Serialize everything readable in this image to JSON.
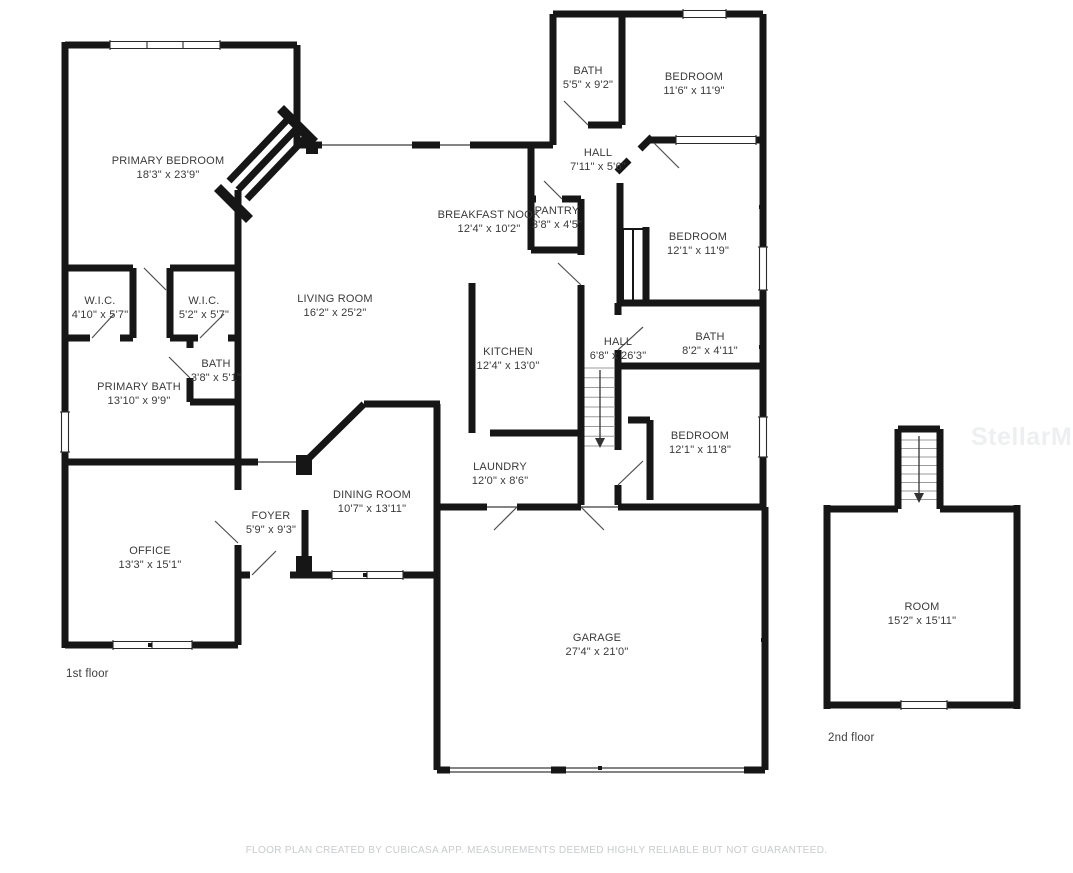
{
  "floorplan": {
    "watermark": "StellarMLS",
    "footer": "FLOOR PLAN CREATED BY CUBICASA APP. MEASUREMENTS DEEMED HIGHLY RELIABLE BUT NOT GUARANTEED.",
    "colors": {
      "wall": "#161616",
      "label": "#3a3a3a",
      "footer": "#c8cbcd",
      "watermark": "#edeff0"
    },
    "floors": [
      {
        "label": "1st floor",
        "label_x": 66,
        "label_y": 668,
        "rooms": [
          {
            "name": "PRIMARY BEDROOM",
            "dims": "18'3\" x 23'9\"",
            "x": 168,
            "y": 155
          },
          {
            "name": "W.I.C.",
            "dims": "4'10\" x 5'7\"",
            "x": 100,
            "y": 295
          },
          {
            "name": "W.I.C.",
            "dims": "5'2\" x 5'7\"",
            "x": 204,
            "y": 295
          },
          {
            "name": "BATH",
            "dims": "3'8\" x 5'1\"",
            "x": 216,
            "y": 358
          },
          {
            "name": "PRIMARY BATH",
            "dims": "13'10\" x 9'9\"",
            "x": 139,
            "y": 381
          },
          {
            "name": "OFFICE",
            "dims": "13'3\" x 15'1\"",
            "x": 150,
            "y": 545
          },
          {
            "name": "FOYER",
            "dims": "5'9\" x 9'3\"",
            "x": 271,
            "y": 510
          },
          {
            "name": "DINING ROOM",
            "dims": "10'7\" x 13'11\"",
            "x": 372,
            "y": 489
          },
          {
            "name": "LIVING ROOM",
            "dims": "16'2\" x 25'2\"",
            "x": 335,
            "y": 293
          },
          {
            "name": "BREAKFAST NOOK",
            "dims": "12'4\" x 10'2\"",
            "x": 489,
            "y": 209
          },
          {
            "name": "PANTRY",
            "dims": "3'8\" x 4'5\"",
            "x": 557,
            "y": 205
          },
          {
            "name": "KITCHEN",
            "dims": "12'4\" x 13'0\"",
            "x": 508,
            "y": 346
          },
          {
            "name": "LAUNDRY",
            "dims": "12'0\" x 8'6\"",
            "x": 500,
            "y": 461
          },
          {
            "name": "HALL",
            "dims": "7'11\" x 5'6\"",
            "x": 598,
            "y": 147
          },
          {
            "name": "HALL",
            "dims": "6'8\" x 26'3\"",
            "x": 618,
            "y": 336
          },
          {
            "name": "BATH",
            "dims": "5'5\" x 9'2\"",
            "x": 588,
            "y": 65
          },
          {
            "name": "BEDROOM",
            "dims": "11'6\" x 11'9\"",
            "x": 694,
            "y": 71
          },
          {
            "name": "BEDROOM",
            "dims": "12'1\" x 11'9\"",
            "x": 698,
            "y": 231
          },
          {
            "name": "BATH",
            "dims": "8'2\" x 4'11\"",
            "x": 710,
            "y": 331
          },
          {
            "name": "BEDROOM",
            "dims": "12'1\" x 11'8\"",
            "x": 700,
            "y": 430
          },
          {
            "name": "GARAGE",
            "dims": "27'4\" x 21'0\"",
            "x": 597,
            "y": 632
          }
        ]
      },
      {
        "label": "2nd floor",
        "label_x": 828,
        "label_y": 732,
        "rooms": [
          {
            "name": "ROOM",
            "dims": "15'2\" x 15'11\"",
            "x": 922,
            "y": 601
          }
        ]
      }
    ]
  }
}
